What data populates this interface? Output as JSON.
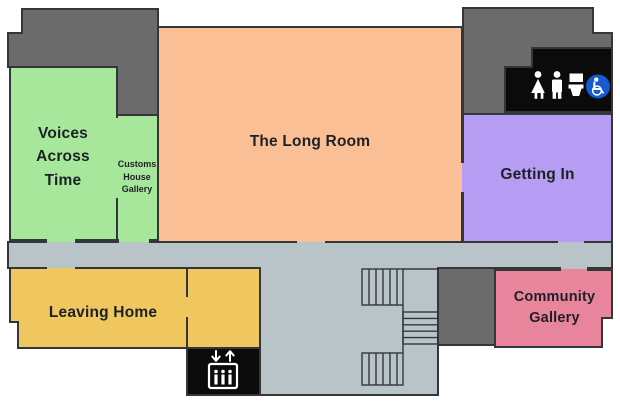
{
  "floor_plan": {
    "rooms": [
      {
        "id": "voices-across-time",
        "label": "Voices Across Time",
        "color": "#a7e79c"
      },
      {
        "id": "customs-house-gallery",
        "label": "Customs House Gallery",
        "color": "#a7e79c"
      },
      {
        "id": "the-long-room",
        "label": "The Long Room",
        "color": "#fbbf95"
      },
      {
        "id": "getting-in",
        "label": "Getting In",
        "color": "#b69cf2"
      },
      {
        "id": "leaving-home",
        "label": "Leaving Home",
        "color": "#f0c75e"
      },
      {
        "id": "community-gallery",
        "label": "Community Gallery",
        "color": "#e8849b"
      }
    ],
    "facilities": [
      {
        "id": "toilets",
        "icons": [
          "female-icon",
          "male-icon",
          "toilet-icon",
          "wheelchair-accessible-icon"
        ],
        "background": "#0b0b0b",
        "accessible_badge_color": "#1659d2"
      },
      {
        "id": "lift",
        "icons": [
          "down-arrow-icon",
          "up-arrow-icon",
          "lift-car-icon",
          "people-icon"
        ],
        "background": "#0b0b0b"
      }
    ],
    "features": [
      {
        "id": "stairs"
      }
    ],
    "colors": {
      "corridor": "#b8c4c7",
      "service_area": "#6b6b6b",
      "wall": "#33373a",
      "icon": "#ffffff",
      "text": "#1d2126",
      "background": "#ffffff"
    }
  }
}
